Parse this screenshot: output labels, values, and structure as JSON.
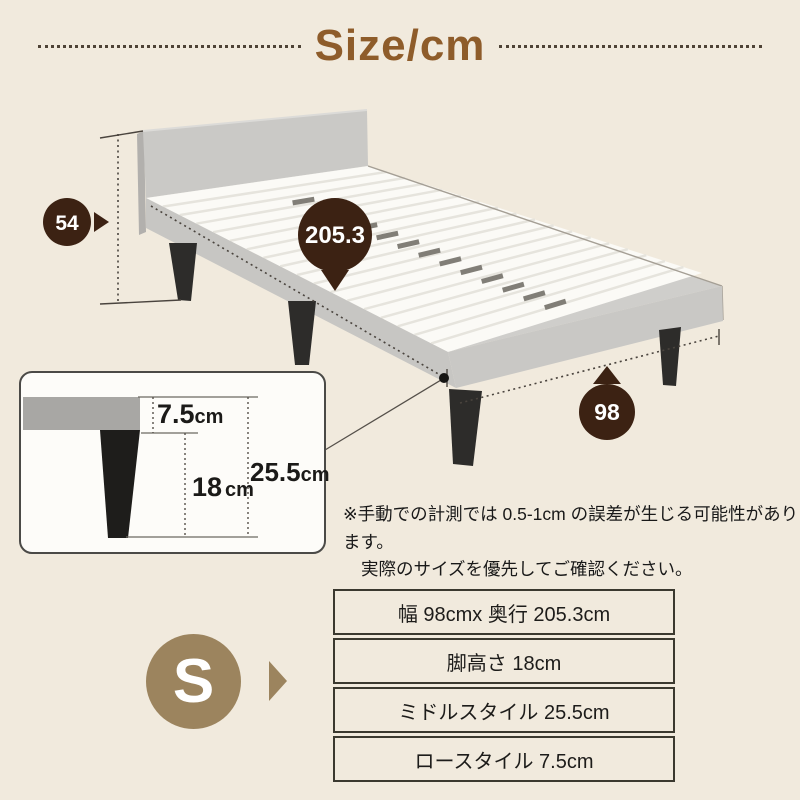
{
  "header": {
    "title": "Size/cm"
  },
  "dimensions": {
    "headboard_height": "54",
    "length": "205.3",
    "width": "98"
  },
  "leg_detail": {
    "frame_height_value": "7.5",
    "leg_height_value": "18",
    "total_height_value": "25.5",
    "unit": "cm"
  },
  "note": {
    "line1": "※手動での計測では 0.5-1cm の誤差が生じる可能性があります。",
    "line2": "実際のサイズを優先してご確認ください。"
  },
  "size_badge": {
    "label": "S"
  },
  "spec_table": {
    "rows": [
      "幅 98cmx 奥行 205.3cm",
      "脚高さ 18cm",
      "ミドルスタイル 25.5cm",
      "ロースタイル 7.5cm"
    ]
  },
  "colors": {
    "background": "#f1eadd",
    "title_brown": "#8e5c2a",
    "marker_dark_brown": "#3c2213",
    "badge_tan": "#9c845e"
  }
}
